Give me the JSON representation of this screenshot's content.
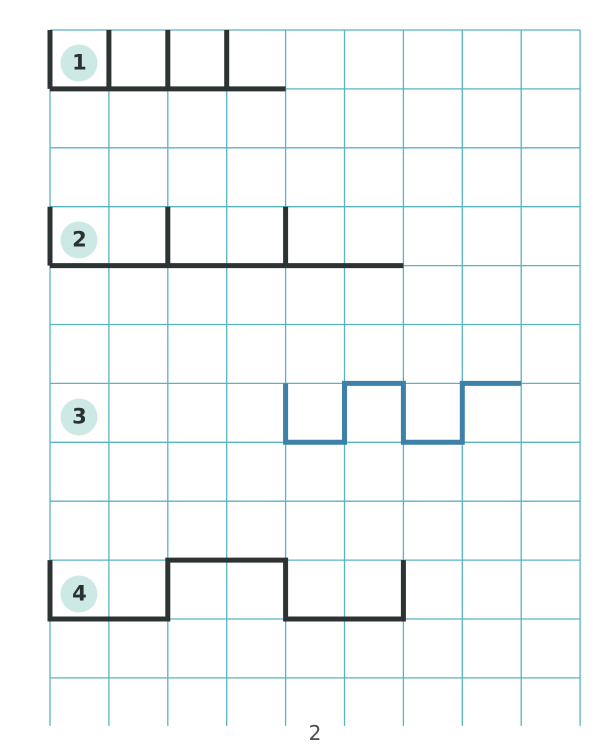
{
  "page": {
    "background": "#ffffff",
    "page_number": "2",
    "page_number_color": "#4c4c4c",
    "page_number_y": 733
  },
  "grid": {
    "color": "#58b4c2",
    "stroke_width": 1.3,
    "left": 50,
    "top": 30,
    "cols": 9,
    "rows": 11,
    "cell": 58.9,
    "bottom_stub": 48
  },
  "badge": {
    "fill": "#cde9e6",
    "text_color": "#2b3031",
    "center_offset_y": 4
  },
  "colors": {
    "dark_line": "#2d3233",
    "blue_line": "#3d80a8"
  },
  "pattern_stroke_width": 5,
  "patterns": [
    {
      "number": "1",
      "color_key": "dark_line",
      "badge_cell": [
        0,
        0
      ],
      "strokes": [
        [
          [
            0,
            1
          ],
          [
            4,
            1
          ]
        ],
        [
          [
            0,
            0
          ],
          [
            0,
            1
          ]
        ],
        [
          [
            1,
            0
          ],
          [
            1,
            1
          ]
        ],
        [
          [
            2,
            0
          ],
          [
            2,
            1
          ]
        ],
        [
          [
            3,
            0
          ],
          [
            3,
            1
          ]
        ]
      ]
    },
    {
      "number": "2",
      "color_key": "dark_line",
      "badge_cell": [
        0,
        3
      ],
      "strokes": [
        [
          [
            0,
            4
          ],
          [
            6,
            4
          ]
        ],
        [
          [
            0,
            3
          ],
          [
            0,
            4
          ]
        ],
        [
          [
            2,
            3
          ],
          [
            2,
            4
          ]
        ],
        [
          [
            4,
            3
          ],
          [
            4,
            4
          ]
        ]
      ]
    },
    {
      "number": "3",
      "color_key": "blue_line",
      "badge_cell": [
        0,
        6
      ],
      "strokes": [
        [
          [
            4,
            6
          ],
          [
            4,
            7
          ],
          [
            5,
            7
          ],
          [
            5,
            6
          ],
          [
            6,
            6
          ],
          [
            6,
            7
          ],
          [
            7,
            7
          ],
          [
            7,
            6
          ],
          [
            8,
            6
          ]
        ]
      ]
    },
    {
      "number": "4",
      "color_key": "dark_line",
      "badge_cell": [
        0,
        9
      ],
      "strokes": [
        [
          [
            0,
            9
          ],
          [
            0,
            10
          ],
          [
            2,
            10
          ],
          [
            2,
            9
          ],
          [
            4,
            9
          ],
          [
            4,
            10
          ],
          [
            6,
            10
          ],
          [
            6,
            9
          ]
        ]
      ]
    }
  ]
}
